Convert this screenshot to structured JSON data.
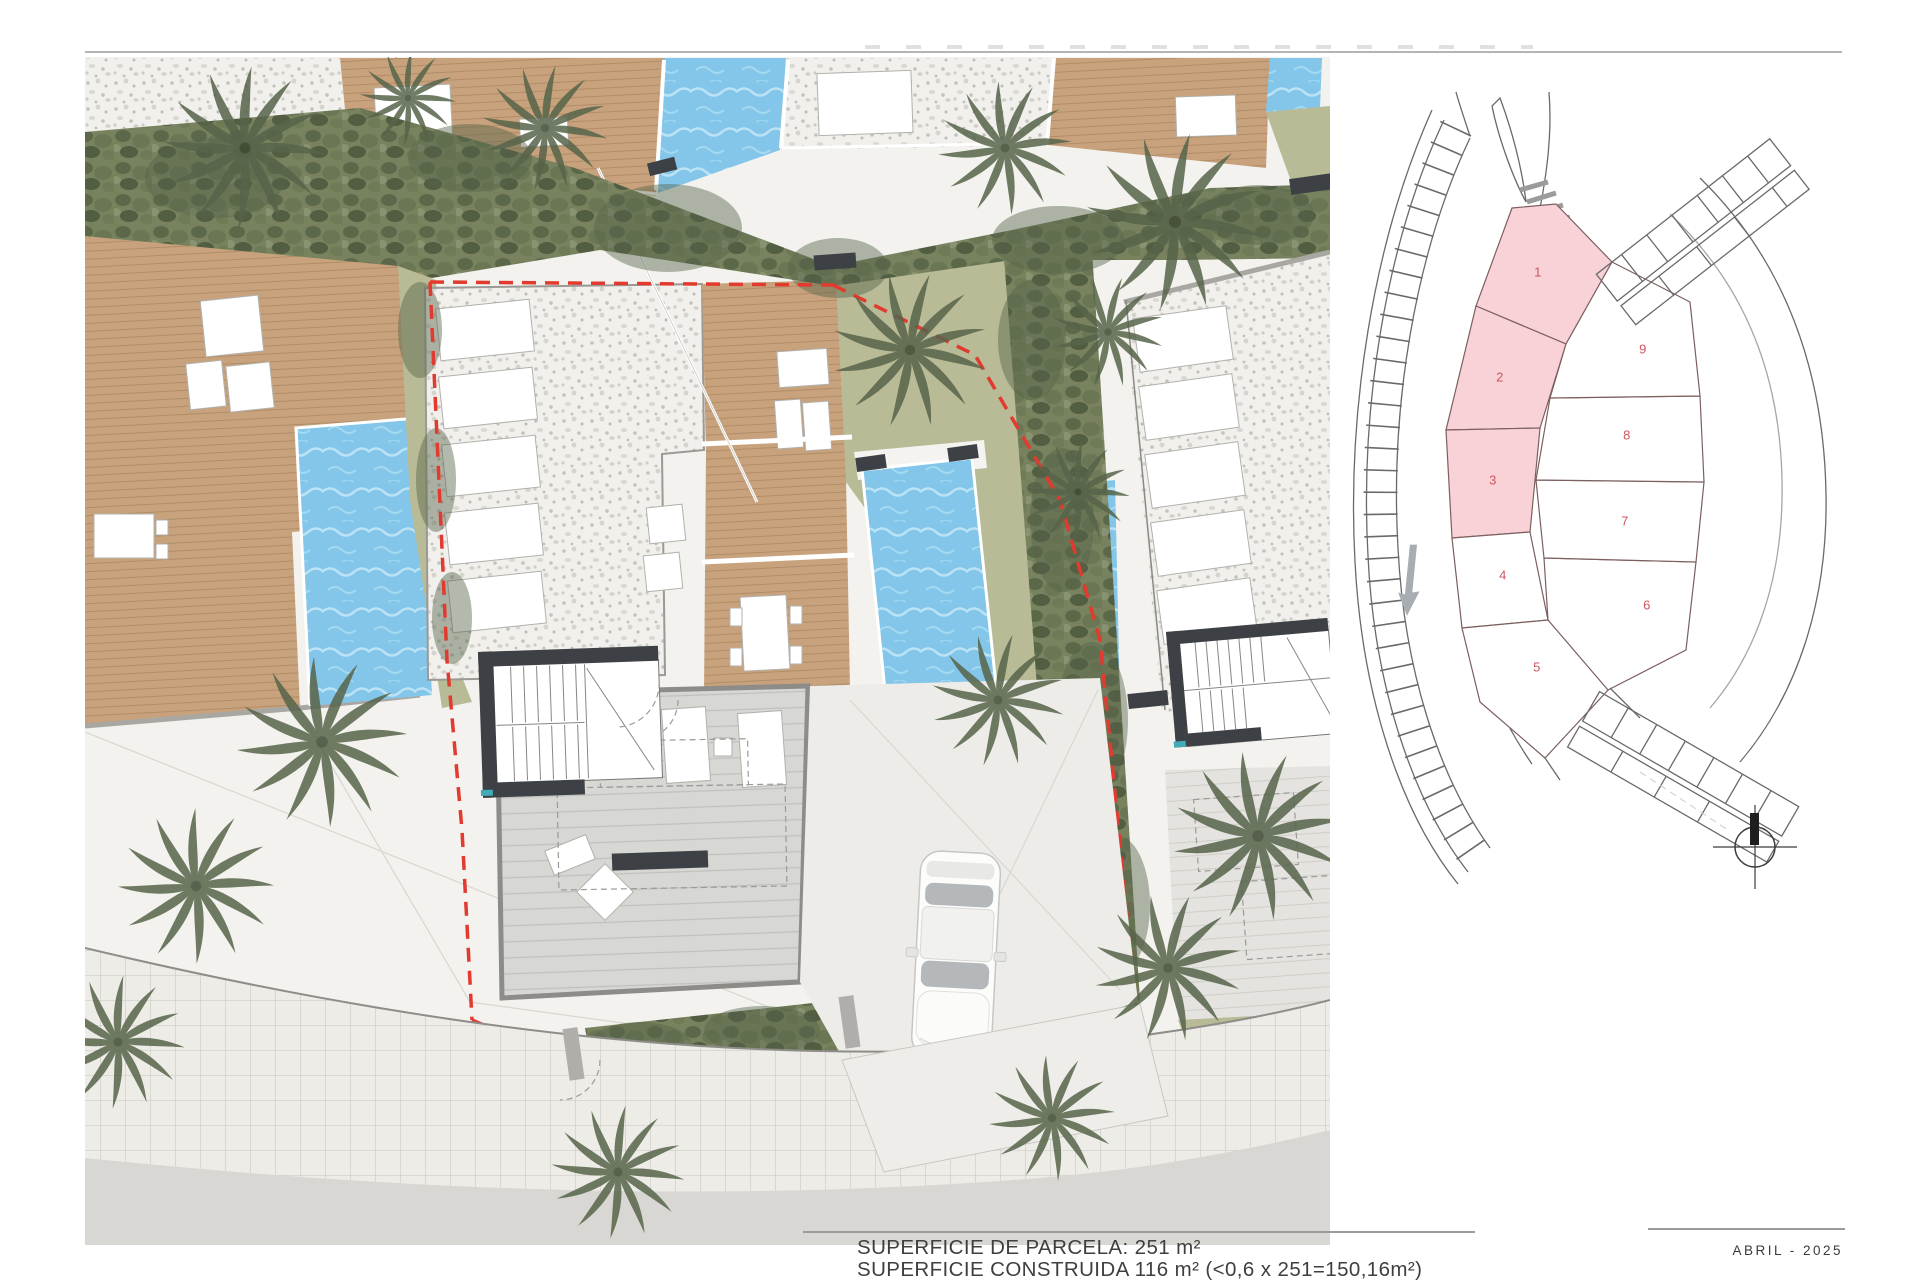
{
  "annotations": {
    "parcel_area_line": "SUPERFICIE DE PARCELA: 251 m²",
    "built_area_line": "SUPERFICIE CONSTRUIDA 116 m² (<0,6 x 251=150,16m²)",
    "date": "ABRIL - 2025"
  },
  "key_plan": {
    "plots": [
      {
        "number": "1",
        "highlighted": true
      },
      {
        "number": "2",
        "highlighted": true
      },
      {
        "number": "3",
        "highlighted": true
      },
      {
        "number": "4",
        "highlighted": false
      },
      {
        "number": "5",
        "highlighted": false
      },
      {
        "number": "6",
        "highlighted": false
      },
      {
        "number": "7",
        "highlighted": false
      },
      {
        "number": "8",
        "highlighted": false
      },
      {
        "number": "9",
        "highlighted": false
      }
    ]
  },
  "colors": {
    "plot-pink": "#f8d2d7",
    "plot-number-red": "#cd5660",
    "boundary-red": "#e23a2e",
    "pool-blue": "#83c6e9",
    "pool-ripple": "#c6e7f6",
    "deck-tan": "#c7a27d",
    "deck-line": "#b18d67",
    "lawn-olive": "#b8bb96",
    "hedge-green": "#78825e",
    "hedge-dark": "#57644a",
    "gravel-light": "#f1f0ec",
    "gravel-dot": "#c4c2bc",
    "plaza-light": "#f3f2ee",
    "road-gray": "#d8d7d3",
    "sidewalk-gray": "#edece7",
    "tile-line": "#c9c6c0",
    "wall-dark": "#3d4145",
    "curb-gray": "#a9a7a2",
    "key-line": "#6a6a6a",
    "arrow-gray": "#a7adb2",
    "teal-mark": "#43aab8",
    "car-glass": "#b4b8ba"
  }
}
